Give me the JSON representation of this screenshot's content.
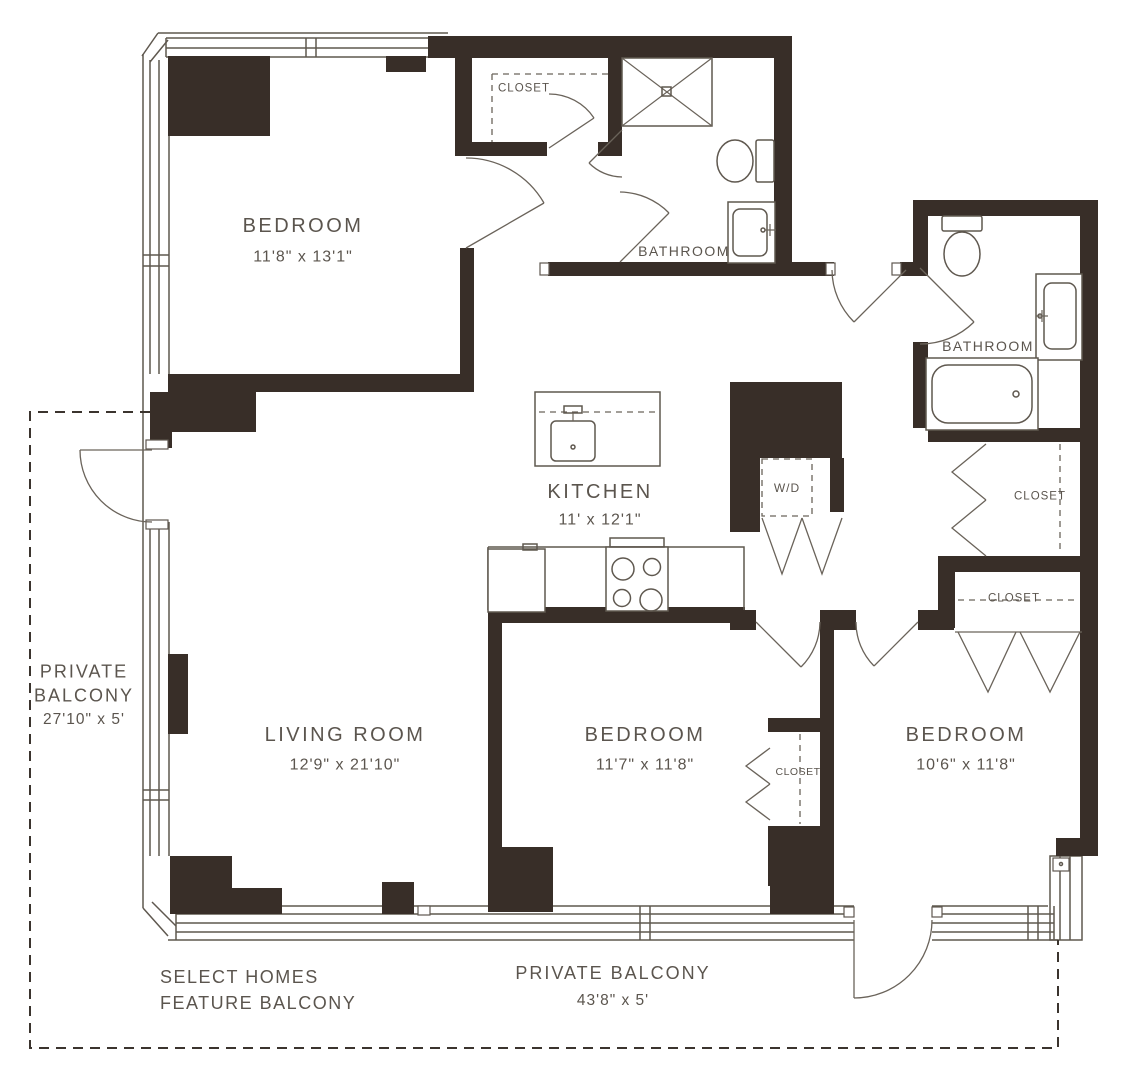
{
  "colors": {
    "wall": "#382e28",
    "line": "#5f584f",
    "text": "#5b554e",
    "background": "#ffffff"
  },
  "rooms": {
    "bedroom_top": {
      "name": "BEDROOM",
      "dims": "11'8\" x 13'1\""
    },
    "bathroom_top": {
      "name": "BATHROOM"
    },
    "bathroom_right": {
      "name": "BATHROOM"
    },
    "kitchen": {
      "name": "KITCHEN",
      "dims": "11' x 12'1\""
    },
    "living_room": {
      "name": "LIVING ROOM",
      "dims": "12'9\" x 21'10\""
    },
    "bedroom_middle": {
      "name": "BEDROOM",
      "dims": "11'7\" x 11'8\""
    },
    "bedroom_right": {
      "name": "BEDROOM",
      "dims": "10'6\" x 11'8\""
    },
    "balcony_left": {
      "name": "PRIVATE\nBALCONY",
      "dims": "27'10\" x 5'"
    },
    "balcony_bottom": {
      "name": "PRIVATE BALCONY",
      "dims": "43'8\" x 5'"
    }
  },
  "closets": {
    "bedroom_top_closet": "CLOSET",
    "hall_closet_upper": "CLOSET",
    "hall_closet_lower": "CLOSET",
    "bedroom_middle_closet": "CLOSET",
    "washer_dryer": "W/D"
  },
  "notes": {
    "balcony_note": "SELECT HOMES\nFEATURE BALCONY"
  }
}
